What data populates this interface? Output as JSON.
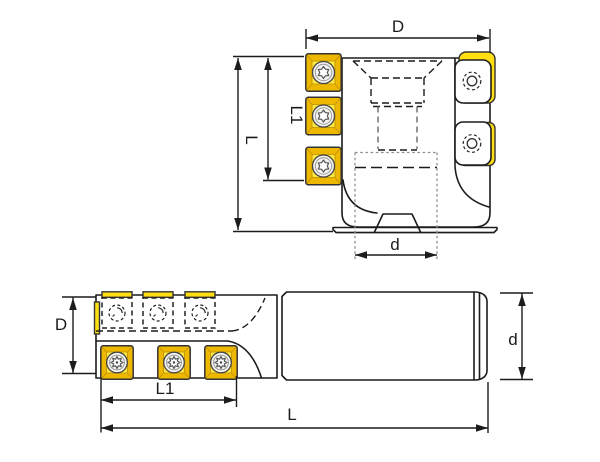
{
  "colors": {
    "bg": "#ffffff",
    "line_dark": "#1c1c1c",
    "hidden_gray": "#909090",
    "insert_yellow": "#ffdf12",
    "insert_shadow": "#eeb800",
    "insert_face": "#ffe742",
    "screw_silver": "#f4f4f2"
  },
  "views": {
    "top": {
      "labels": {
        "D": "D",
        "L": "L",
        "L1": "L1",
        "d": "d"
      }
    },
    "bottom": {
      "labels": {
        "D": "D",
        "L1": "L1",
        "L": "L",
        "d": "d"
      }
    }
  }
}
